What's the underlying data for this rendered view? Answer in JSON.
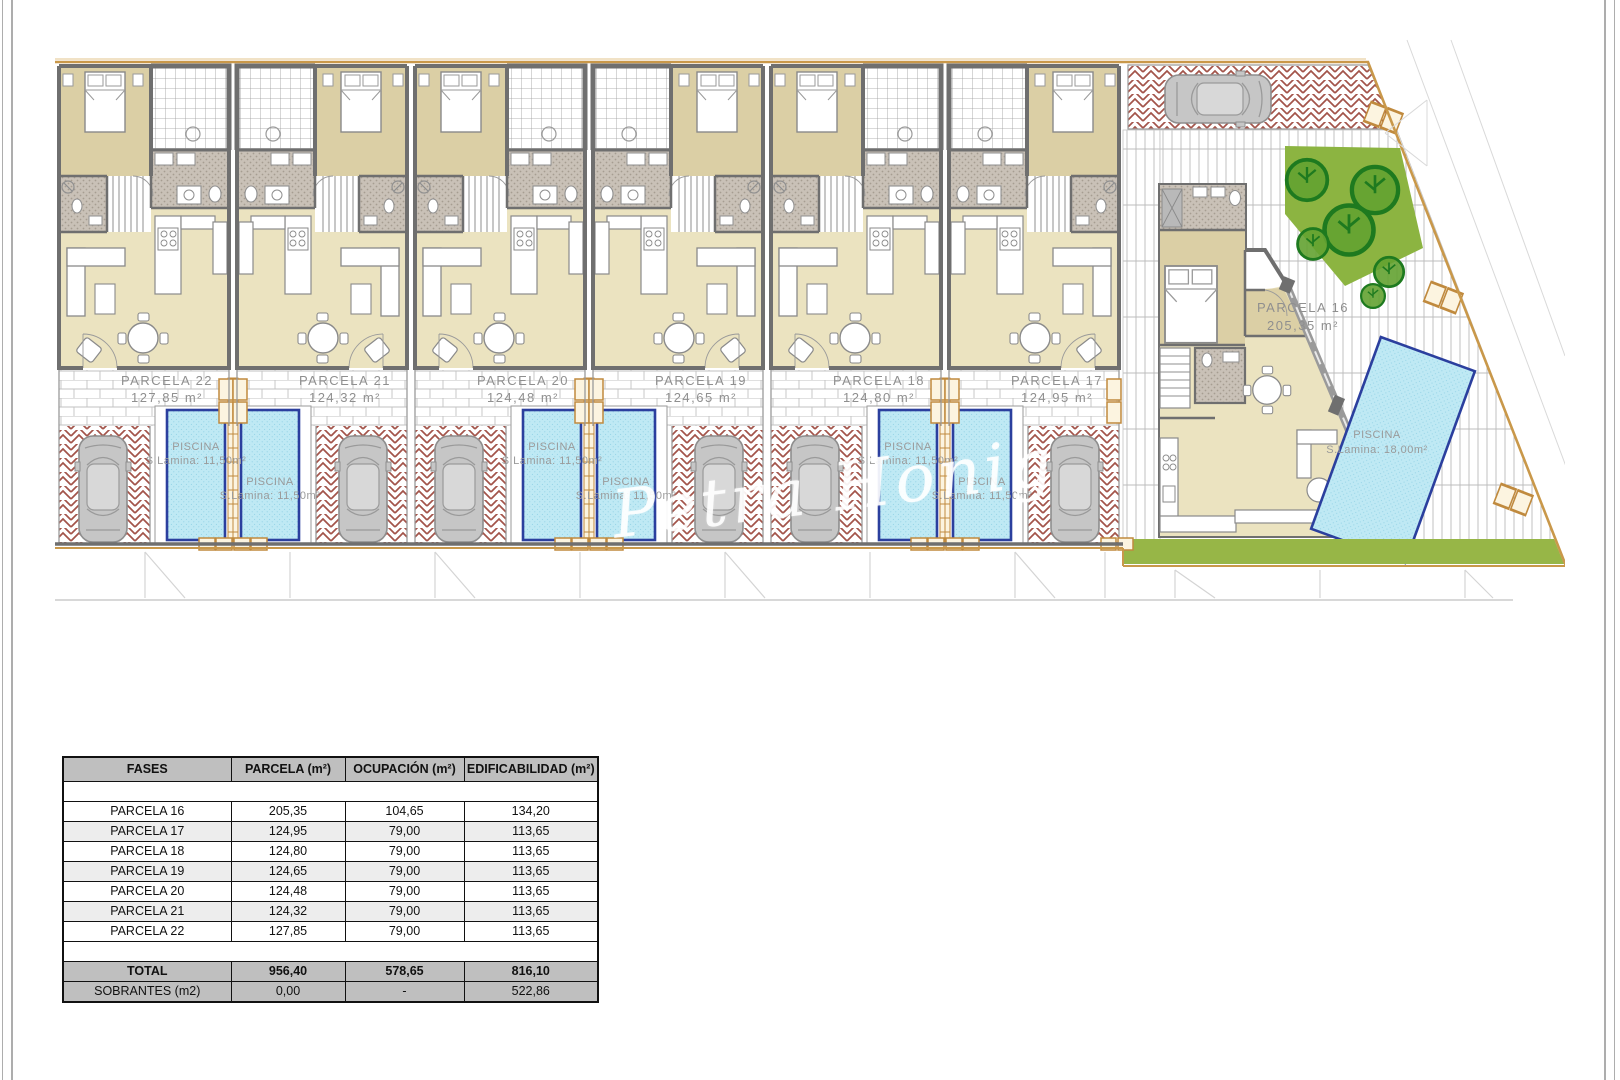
{
  "plan": {
    "watermark": "Petra Honig",
    "parcels": [
      {
        "name": "PARCELA 22",
        "area": "127,85 m²"
      },
      {
        "name": "PARCELA 21",
        "area": "124,32 m²"
      },
      {
        "name": "PARCELA 20",
        "area": "124,48 m²"
      },
      {
        "name": "PARCELA 19",
        "area": "124,65 m²"
      },
      {
        "name": "PARCELA 18",
        "area": "124,80 m²"
      },
      {
        "name": "PARCELA 17",
        "area": "124,95 m²"
      },
      {
        "name": "PARCELA 16",
        "area": "205,35 m²"
      }
    ],
    "pool_label": {
      "line1": "PISCINA",
      "line2": "S.Lamina: 11,50m²"
    },
    "villa_pool_label": {
      "line1": "PISCINA",
      "line2": "S.Lamina: 18,00m²"
    }
  },
  "table": {
    "headers": [
      "FASES",
      "PARCELA (m²)",
      "OCUPACIÓN (m²)",
      "EDIFICABILIDAD (m²)"
    ],
    "rows": [
      {
        "fase": "PARCELA 16",
        "parcela": "205,35",
        "ocupacion": "104,65",
        "edificabilidad": "134,20"
      },
      {
        "fase": "PARCELA 17",
        "parcela": "124,95",
        "ocupacion": "79,00",
        "edificabilidad": "113,65"
      },
      {
        "fase": "PARCELA 18",
        "parcela": "124,80",
        "ocupacion": "79,00",
        "edificabilidad": "113,65"
      },
      {
        "fase": "PARCELA 19",
        "parcela": "124,65",
        "ocupacion": "79,00",
        "edificabilidad": "113,65"
      },
      {
        "fase": "PARCELA 20",
        "parcela": "124,48",
        "ocupacion": "79,00",
        "edificabilidad": "113,65"
      },
      {
        "fase": "PARCELA 21",
        "parcela": "124,32",
        "ocupacion": "79,00",
        "edificabilidad": "113,65"
      },
      {
        "fase": "PARCELA 22",
        "parcela": "127,85",
        "ocupacion": "79,00",
        "edificabilidad": "113,65"
      }
    ],
    "total": {
      "fase": "TOTAL",
      "parcela": "956,40",
      "ocupacion": "578,65",
      "edificabilidad": "816,10"
    },
    "sobrantes": {
      "fase": "SOBRANTES (m2)",
      "parcela": "0,00",
      "ocupacion": "-",
      "edificabilidad": "522,86"
    }
  },
  "colors": {
    "pool_blue": "#bfe9f4",
    "pool_border": "#2b3f9e",
    "driveway_hatch_red": "#a3544a",
    "garden_green": "#8cb441",
    "boundary_orange": "#c9984a",
    "room_cream": "#ebe3c0",
    "bedroom_tan": "#dbcfa5",
    "wall_gray": "#6f6f6f",
    "table_header_gray": "#bfbfbf"
  }
}
